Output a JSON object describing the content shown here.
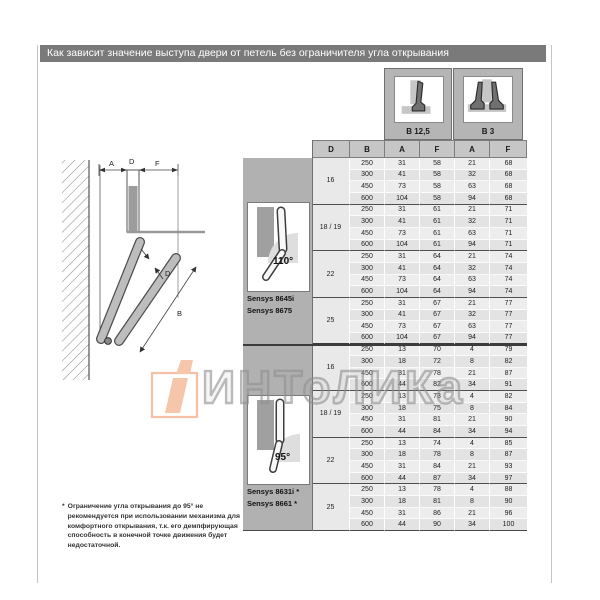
{
  "page": {
    "title": "Как зависит значение выступа двери от петель без ограничителя угла открывания"
  },
  "legend": [
    {
      "label": "B 12,5",
      "icon": "hinge-mounting-plate-single-icon"
    },
    {
      "label": "B 3",
      "icon": "hinge-mounting-plate-double-icon"
    }
  ],
  "diagram": {
    "dim_a": "A",
    "dim_d_top": "D",
    "dim_f": "F",
    "dim_d_door": "D",
    "dim_b": "B"
  },
  "table": {
    "columns": [
      "D",
      "B",
      "A",
      "F",
      "A",
      "F"
    ],
    "sections": [
      {
        "angle": "110°",
        "models": [
          "Sensys 8645i",
          "Sensys 8675"
        ],
        "groups": [
          {
            "d": "16",
            "rows": [
              [
                "250",
                "31",
                "58",
                "21",
                "68"
              ],
              [
                "300",
                "41",
                "58",
                "32",
                "68"
              ],
              [
                "450",
                "73",
                "58",
                "63",
                "68"
              ],
              [
                "600",
                "104",
                "58",
                "94",
                "68"
              ]
            ]
          },
          {
            "d": "18 / 19",
            "rows": [
              [
                "250",
                "31",
                "61",
                "21",
                "71"
              ],
              [
                "300",
                "41",
                "61",
                "32",
                "71"
              ],
              [
                "450",
                "73",
                "61",
                "63",
                "71"
              ],
              [
                "600",
                "104",
                "61",
                "94",
                "71"
              ]
            ]
          },
          {
            "d": "22",
            "rows": [
              [
                "250",
                "31",
                "64",
                "21",
                "74"
              ],
              [
                "300",
                "41",
                "64",
                "32",
                "74"
              ],
              [
                "450",
                "73",
                "64",
                "63",
                "74"
              ],
              [
                "600",
                "104",
                "64",
                "94",
                "74"
              ]
            ]
          },
          {
            "d": "25",
            "rows": [
              [
                "250",
                "31",
                "67",
                "21",
                "77"
              ],
              [
                "300",
                "41",
                "67",
                "32",
                "77"
              ],
              [
                "450",
                "73",
                "67",
                "63",
                "77"
              ],
              [
                "600",
                "104",
                "67",
                "94",
                "77"
              ]
            ]
          }
        ]
      },
      {
        "angle": "95°",
        "models": [
          "Sensys 8631i *",
          "Sensys 8661 *"
        ],
        "groups": [
          {
            "d": "16",
            "rows": [
              [
                "250",
                "13",
                "70",
                "4",
                "79"
              ],
              [
                "300",
                "18",
                "72",
                "8",
                "82"
              ],
              [
                "450",
                "31",
                "78",
                "21",
                "87"
              ],
              [
                "600",
                "44",
                "82",
                "34",
                "91"
              ]
            ]
          },
          {
            "d": "18 / 19",
            "rows": [
              [
                "250",
                "13",
                "73",
                "4",
                "82"
              ],
              [
                "300",
                "18",
                "75",
                "8",
                "84"
              ],
              [
                "450",
                "31",
                "81",
                "21",
                "90"
              ],
              [
                "600",
                "44",
                "84",
                "34",
                "94"
              ]
            ]
          },
          {
            "d": "22",
            "rows": [
              [
                "250",
                "13",
                "74",
                "4",
                "85"
              ],
              [
                "300",
                "18",
                "78",
                "8",
                "87"
              ],
              [
                "450",
                "31",
                "84",
                "21",
                "93"
              ],
              [
                "600",
                "44",
                "87",
                "34",
                "97"
              ]
            ]
          },
          {
            "d": "25",
            "rows": [
              [
                "250",
                "13",
                "78",
                "4",
                "88"
              ],
              [
                "300",
                "18",
                "81",
                "8",
                "90"
              ],
              [
                "450",
                "31",
                "86",
                "21",
                "96"
              ],
              [
                "600",
                "44",
                "90",
                "34",
                "100"
              ]
            ]
          }
        ]
      }
    ]
  },
  "footnote": {
    "marker": "*",
    "text": "Ограничение угла открывания до 95° не рекомендуется при использовании механизма для комфортного открывания, т.к. его демпфирующая способность в конечной точке движения будет недостаточной."
  },
  "watermark": {
    "text": "ИНТоЛИКа",
    "logo_color": "#F0956A"
  }
}
